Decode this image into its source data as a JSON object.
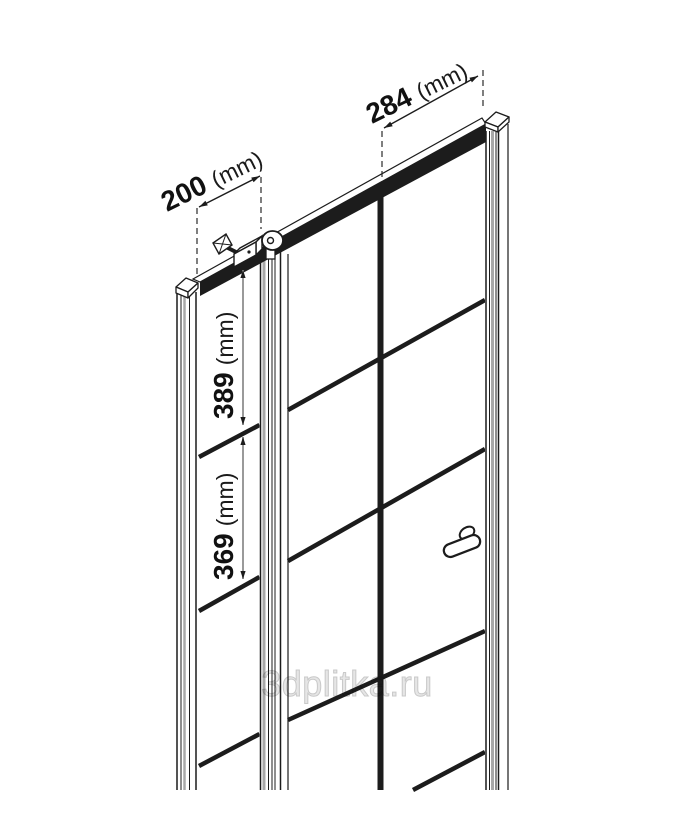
{
  "diagram": {
    "watermark": "3dplitka.ru",
    "dims": {
      "door_width": {
        "value": "284",
        "unit": "(mm)"
      },
      "side_panel_width": {
        "value": "200",
        "unit": "(mm)"
      },
      "upper_section_height": {
        "value": "389",
        "unit": "(mm)"
      },
      "lower_section_height": {
        "value": "369",
        "unit": "(mm)"
      }
    },
    "colors": {
      "line": "#1c1c1c",
      "profile_gray": "#a8a8a8",
      "dimension_gray": "#8f8f8f",
      "watermark_gray": "#d9d9d9",
      "background": "#ffffff"
    }
  }
}
